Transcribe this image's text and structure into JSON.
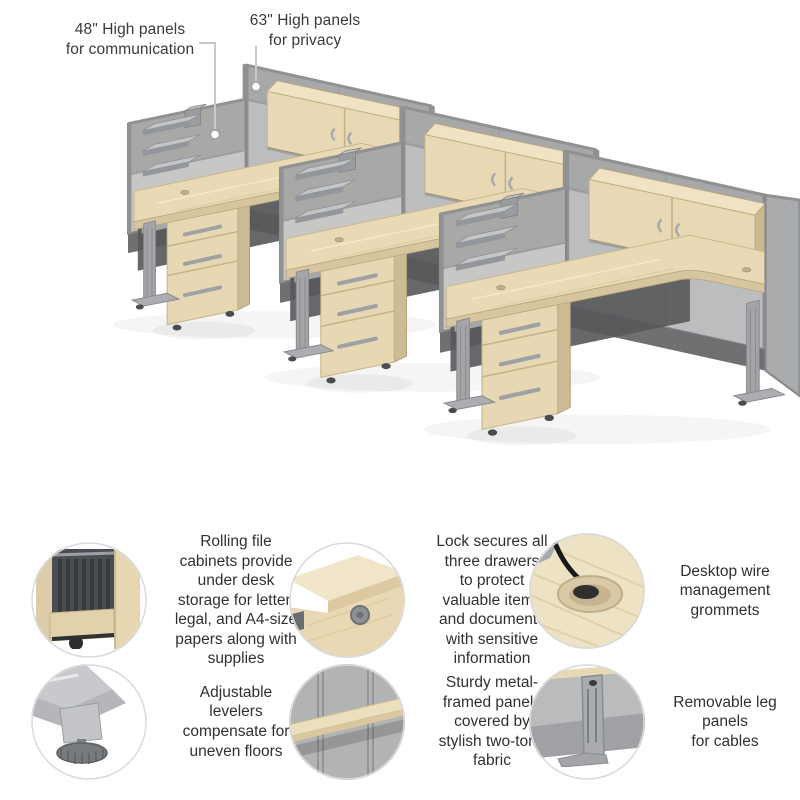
{
  "callouts": [
    {
      "id": "panel-48",
      "label": "48\" High panels\nfor communication"
    },
    {
      "id": "panel-63",
      "label": "63\" High panels\nfor privacy"
    }
  ],
  "features": [
    {
      "id": "rolling-file-cabinets",
      "photo": "open-file-drawer-photo",
      "text": "Rolling file\ncabinets provide\nunder desk\nstorage for letter,\nlegal, and A4-size\npapers along with\nsupplies"
    },
    {
      "id": "drawer-lock",
      "photo": "drawer-lock-photo",
      "text": "Lock secures all\nthree drawers\nto protect\nvaluable items\nand documents\nwith sensitive\ninformation"
    },
    {
      "id": "wire-grommets",
      "photo": "desktop-grommet-photo",
      "text": "Desktop wire\nmanagement\ngrommets"
    },
    {
      "id": "adjustable-levelers",
      "photo": "leveler-foot-photo",
      "text": "Adjustable\nlevelers\ncompensate for\nuneven floors"
    },
    {
      "id": "two-tone-panels",
      "photo": "panel-fabric-photo",
      "text": "Sturdy metal-\nframed panels\ncovered by\nstylish two-tone\nfabric"
    },
    {
      "id": "leg-panels",
      "photo": "leg-panel-photo",
      "text": "Removable leg\npanels\nfor cables"
    }
  ],
  "colors": {
    "wood": "#e9dab5",
    "wood_light": "#f0e4c6",
    "wood_side": "#cdbb93",
    "panel_upper": "#a8a9a7",
    "panel_lower": "#c7c8c6",
    "spine_upper": "#a7a8aa",
    "spine_lower": "#bcbdbf",
    "frame": "#85878a",
    "metal": "#a3a5a8",
    "raceway": "#6e7072",
    "text": "#353535",
    "background": "#ffffff"
  }
}
